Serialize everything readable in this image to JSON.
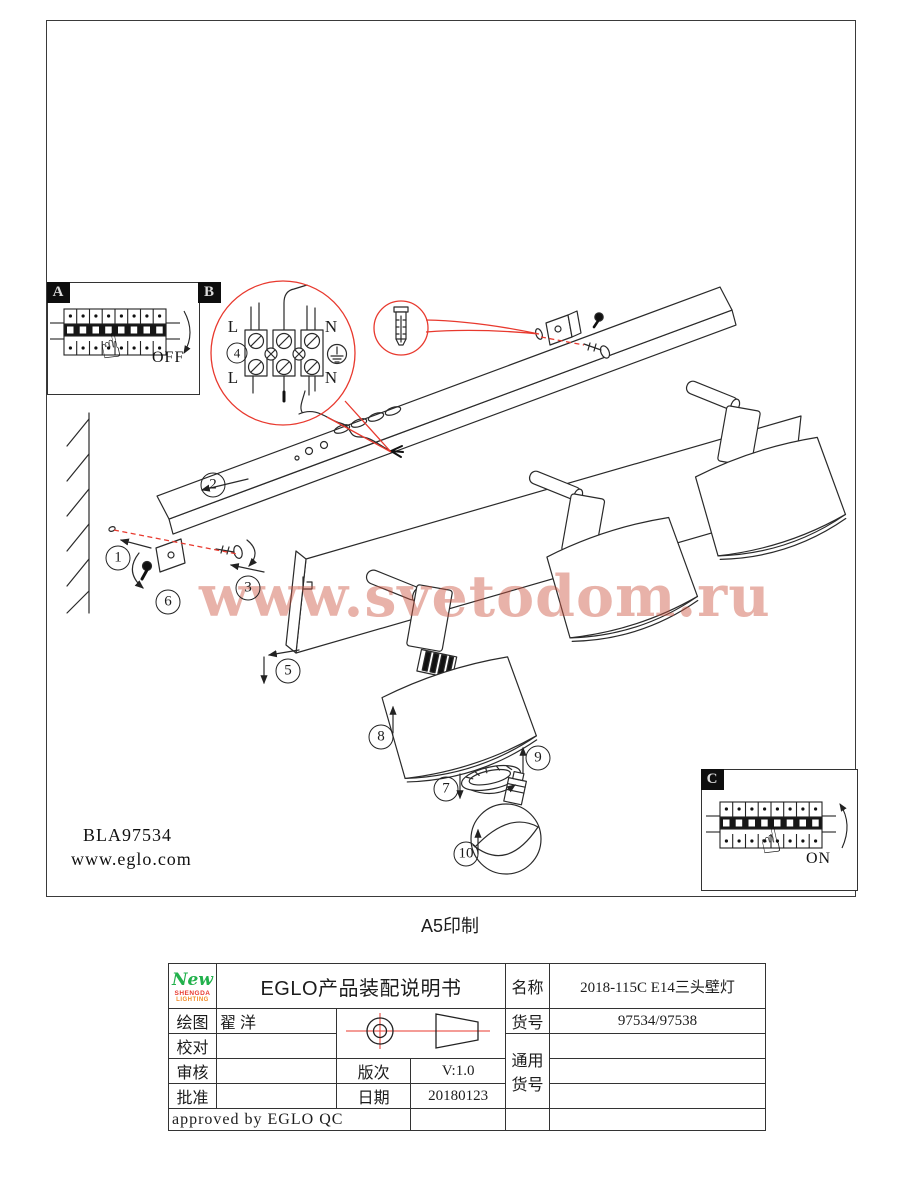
{
  "diagram": {
    "panel_a": {
      "label": "A",
      "state": "OFF",
      "finger_icon": "☝"
    },
    "panel_b": {
      "label": "B"
    },
    "panel_c": {
      "label": "C",
      "state": "ON",
      "finger_icon": "☝"
    },
    "terminal": {
      "step_number": "4",
      "l_top": "L",
      "l_bottom": "L",
      "n_top": "N",
      "n_bottom": "N"
    },
    "steps": {
      "s1": "1",
      "s2": "2",
      "s3": "3",
      "s5": "5",
      "s6": "6",
      "s7": "7",
      "s8": "8",
      "s9": "9",
      "s10": "10"
    },
    "model_code": "BLA97534",
    "website": "www.eglo.com"
  },
  "watermark": "www.svetodom.ru",
  "print_note": "A5印制",
  "title_block": {
    "logo": {
      "script": "New",
      "name": "SHENGDA",
      "sub": "LIGHTING"
    },
    "title": "EGLO产品装配说明书",
    "labels": {
      "draw": "绘图",
      "check": "校对",
      "review": "审核",
      "approve": "批准",
      "version": "版次",
      "date": "日期",
      "name": "名称",
      "item": "货号",
      "common_1": "通用",
      "common_2": "货号"
    },
    "values": {
      "draw": "翟 洋",
      "check": "",
      "review": "",
      "approve": "",
      "version": "V:1.0",
      "date": "20180123",
      "name": "2018-115C E14三头壁灯",
      "item": "97534/97538"
    },
    "approved_note": "approved by EGLO QC"
  },
  "colors": {
    "leader_red": "#e8392e",
    "watermark_red": "#cd5540",
    "logo_green": "#22b14c",
    "logo_red": "#e8392e"
  }
}
